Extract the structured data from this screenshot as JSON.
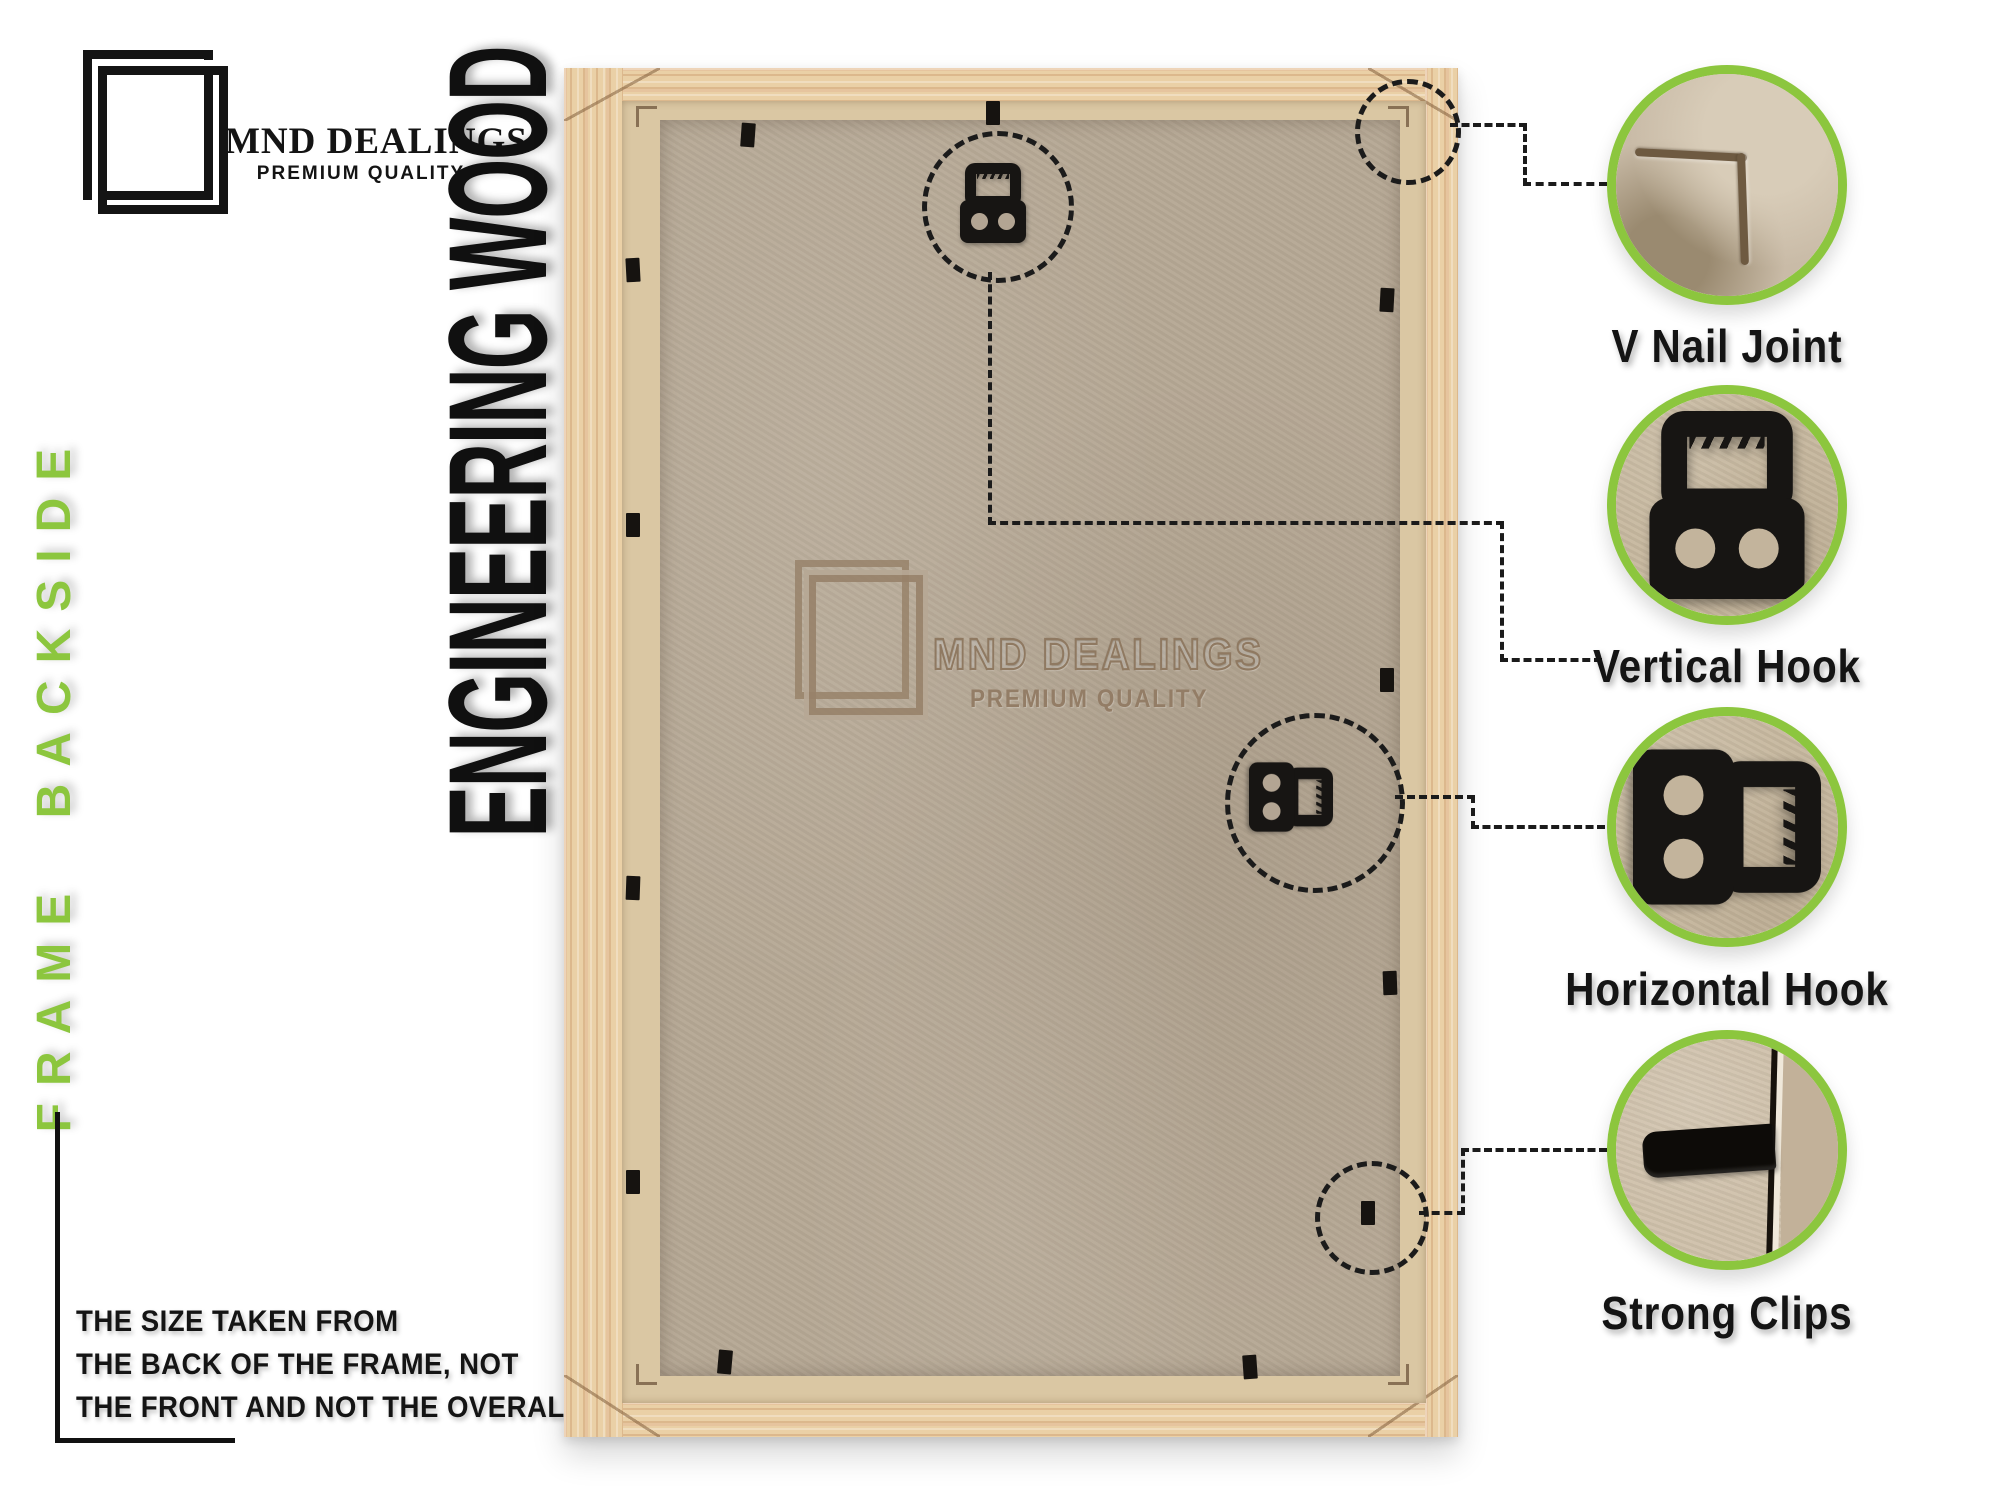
{
  "brand": {
    "name": "MND DEALINGS",
    "tagline": "PREMIUM QUALITY"
  },
  "side_label": "FRAME BACKSIDE",
  "material_label": "ENGINEERING WOOD",
  "watermark": {
    "name": "MND DEALINGS",
    "tagline": "PREMIUM QUALITY"
  },
  "note": {
    "lines": [
      "THE SIZE TAKEN FROM",
      "THE BACK OF THE FRAME, NOT",
      "THE FRONT AND NOT THE OVERALL SIZE."
    ]
  },
  "callouts": [
    {
      "id": "v-nail-joint",
      "label": "V Nail Joint",
      "icon": "v-nail-corner-photo"
    },
    {
      "id": "vertical-hook",
      "label": "Vertical Hook",
      "icon": "vertical-hook-photo"
    },
    {
      "id": "horizontal-hook",
      "label": "Horizontal Hook",
      "icon": "horizontal-hook-photo"
    },
    {
      "id": "strong-clips",
      "label": "Strong Clips",
      "icon": "strong-clip-photo"
    }
  ],
  "colors": {
    "accent_green": "#8cc63e",
    "text_black": "#141414",
    "wood": "#ead0a6",
    "wood_lip": "#dac7a3",
    "back_panel": "#b6a895",
    "watermark_brown": "#937d66",
    "hardware_black": "#171513"
  }
}
